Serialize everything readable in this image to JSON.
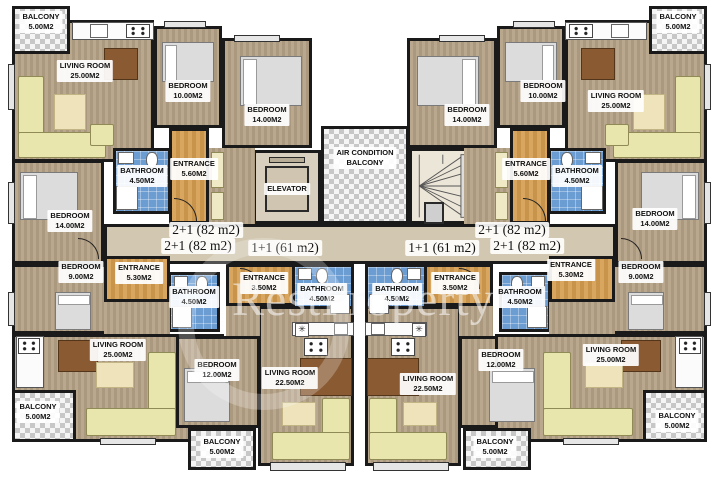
{
  "watermark": "RestProperty",
  "core": {
    "elevator": "ELEVATOR",
    "ac_line1": "AIR CONDITION",
    "ac_line2": "BALCONY"
  },
  "unit_labels": {
    "left_top": "2+1 (82 m2)",
    "left_bottom": "2+1 (82 m2)",
    "center_left": "1+1 (61 m2)",
    "center_right": "1+1 (61 m2)",
    "right_top": "2+1 (82 m2)",
    "right_bottom": "2+1 (82 m2)"
  },
  "rooms": {
    "balcony_tl": {
      "name": "BALCONY",
      "area": "5.00M2"
    },
    "living_tl": {
      "name": "LIVING ROOM",
      "area": "25.00M2"
    },
    "bedroom_tl_10": {
      "name": "BEDROOM",
      "area": "10.00M2"
    },
    "bedroom_tl_14": {
      "name": "BEDROOM",
      "area": "14.00M2"
    },
    "bathroom_tl": {
      "name": "BATHROOM",
      "area": "4.50M2"
    },
    "entrance_tl": {
      "name": "ENTRANCE",
      "area": "5.60M2"
    },
    "balcony_tr": {
      "name": "BALCONY",
      "area": "5.00M2"
    },
    "living_tr": {
      "name": "LIVING ROOM",
      "area": "25.00M2"
    },
    "bedroom_tr_10": {
      "name": "BEDROOM",
      "area": "10.00M2"
    },
    "bedroom_tr_14": {
      "name": "BEDROOM",
      "area": "14.00M2"
    },
    "bathroom_tr": {
      "name": "BATHROOM",
      "area": "4.50M2"
    },
    "entrance_tr": {
      "name": "ENTRANCE",
      "area": "5.60M2"
    },
    "bedroom_bl_14": {
      "name": "BEDROOM",
      "area": "14.00M2"
    },
    "bedroom_bl_9": {
      "name": "BEDROOM",
      "area": "9.00M2"
    },
    "entrance_bl": {
      "name": "ENTRANCE",
      "area": "5.30M2"
    },
    "bathroom_bl": {
      "name": "BATHROOM",
      "area": "4.50M2"
    },
    "living_bl": {
      "name": "LIVING ROOM",
      "area": "25.00M2"
    },
    "balcony_bl": {
      "name": "BALCONY",
      "area": "5.00M2"
    },
    "bedroom_bcl_12": {
      "name": "BEDROOM",
      "area": "12.00M2"
    },
    "balcony_bcl": {
      "name": "BALCONY",
      "area": "5.00M2"
    },
    "entrance_bcl": {
      "name": "ENTRANCE",
      "area": "3.50M2"
    },
    "bathroom_bcl": {
      "name": "BATHROOM",
      "area": "4.50M2"
    },
    "living_bcl": {
      "name": "LIVING ROOM",
      "area": "22.50M2"
    },
    "living_bcr": {
      "name": "LIVING ROOM",
      "area": "22.50M2"
    },
    "bathroom_bcr": {
      "name": "BATHROOM",
      "area": "4.50M2"
    },
    "entrance_bcr": {
      "name": "ENTRANCE",
      "area": "3.50M2"
    },
    "bedroom_bcr_12": {
      "name": "BEDROOM",
      "area": "12.00M2"
    },
    "balcony_bcr": {
      "name": "BALCONY",
      "area": "5.00M2"
    },
    "bedroom_br_14": {
      "name": "BEDROOM",
      "area": "14.00M2"
    },
    "bedroom_br_9": {
      "name": "BEDROOM",
      "area": "9.00M2"
    },
    "entrance_br": {
      "name": "ENTRANCE",
      "area": "5.30M2"
    },
    "bathroom_br": {
      "name": "BATHROOM",
      "area": "4.50M2"
    },
    "living_br": {
      "name": "LIVING ROOM",
      "area": "25.00M2"
    },
    "balcony_br": {
      "name": "BALCONY",
      "area": "5.00M2"
    }
  },
  "colors": {
    "wall": "#1a1a1a",
    "wood_floor": "#b5a289",
    "entrance_floor": "#d09b55",
    "corridor_floor": "#d2c7b0",
    "bathroom_floor": "#6b9dd3",
    "balcony_tile_dark": "#c7c7c7",
    "balcony_tile_light": "#f5f5f5",
    "furniture": "#e9e6ad",
    "table": "#8a5a33",
    "bed": "#dcdcdc",
    "label_bg": "#ffffff",
    "text": "#111111"
  }
}
